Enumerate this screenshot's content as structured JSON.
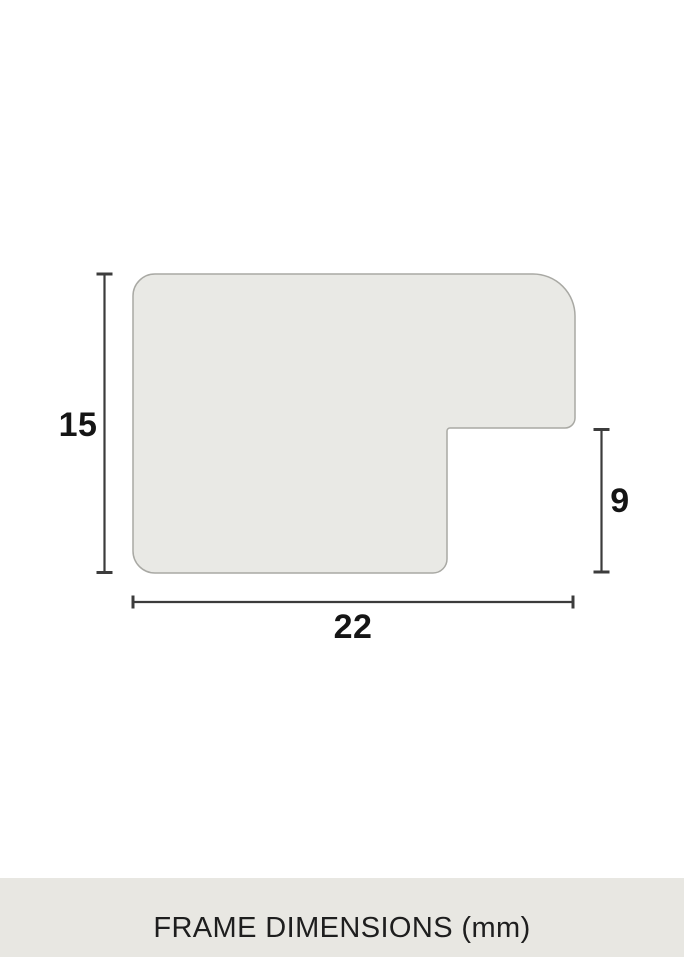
{
  "diagram": {
    "type": "frame-profile-cross-section",
    "dimension_labels": {
      "height": "15",
      "depth": "9",
      "width": "22"
    }
  },
  "footer": {
    "caption": "FRAME DIMENSIONS (mm)"
  },
  "colors": {
    "background": "#ffffff",
    "profile_fill": "#e9e9e5",
    "profile_border": "#a9a9a4",
    "dimension_line": "#3c3c3c",
    "label_text": "#151515",
    "footer_band": "#e8e7e2",
    "footer_text": "#1e1e1e"
  }
}
